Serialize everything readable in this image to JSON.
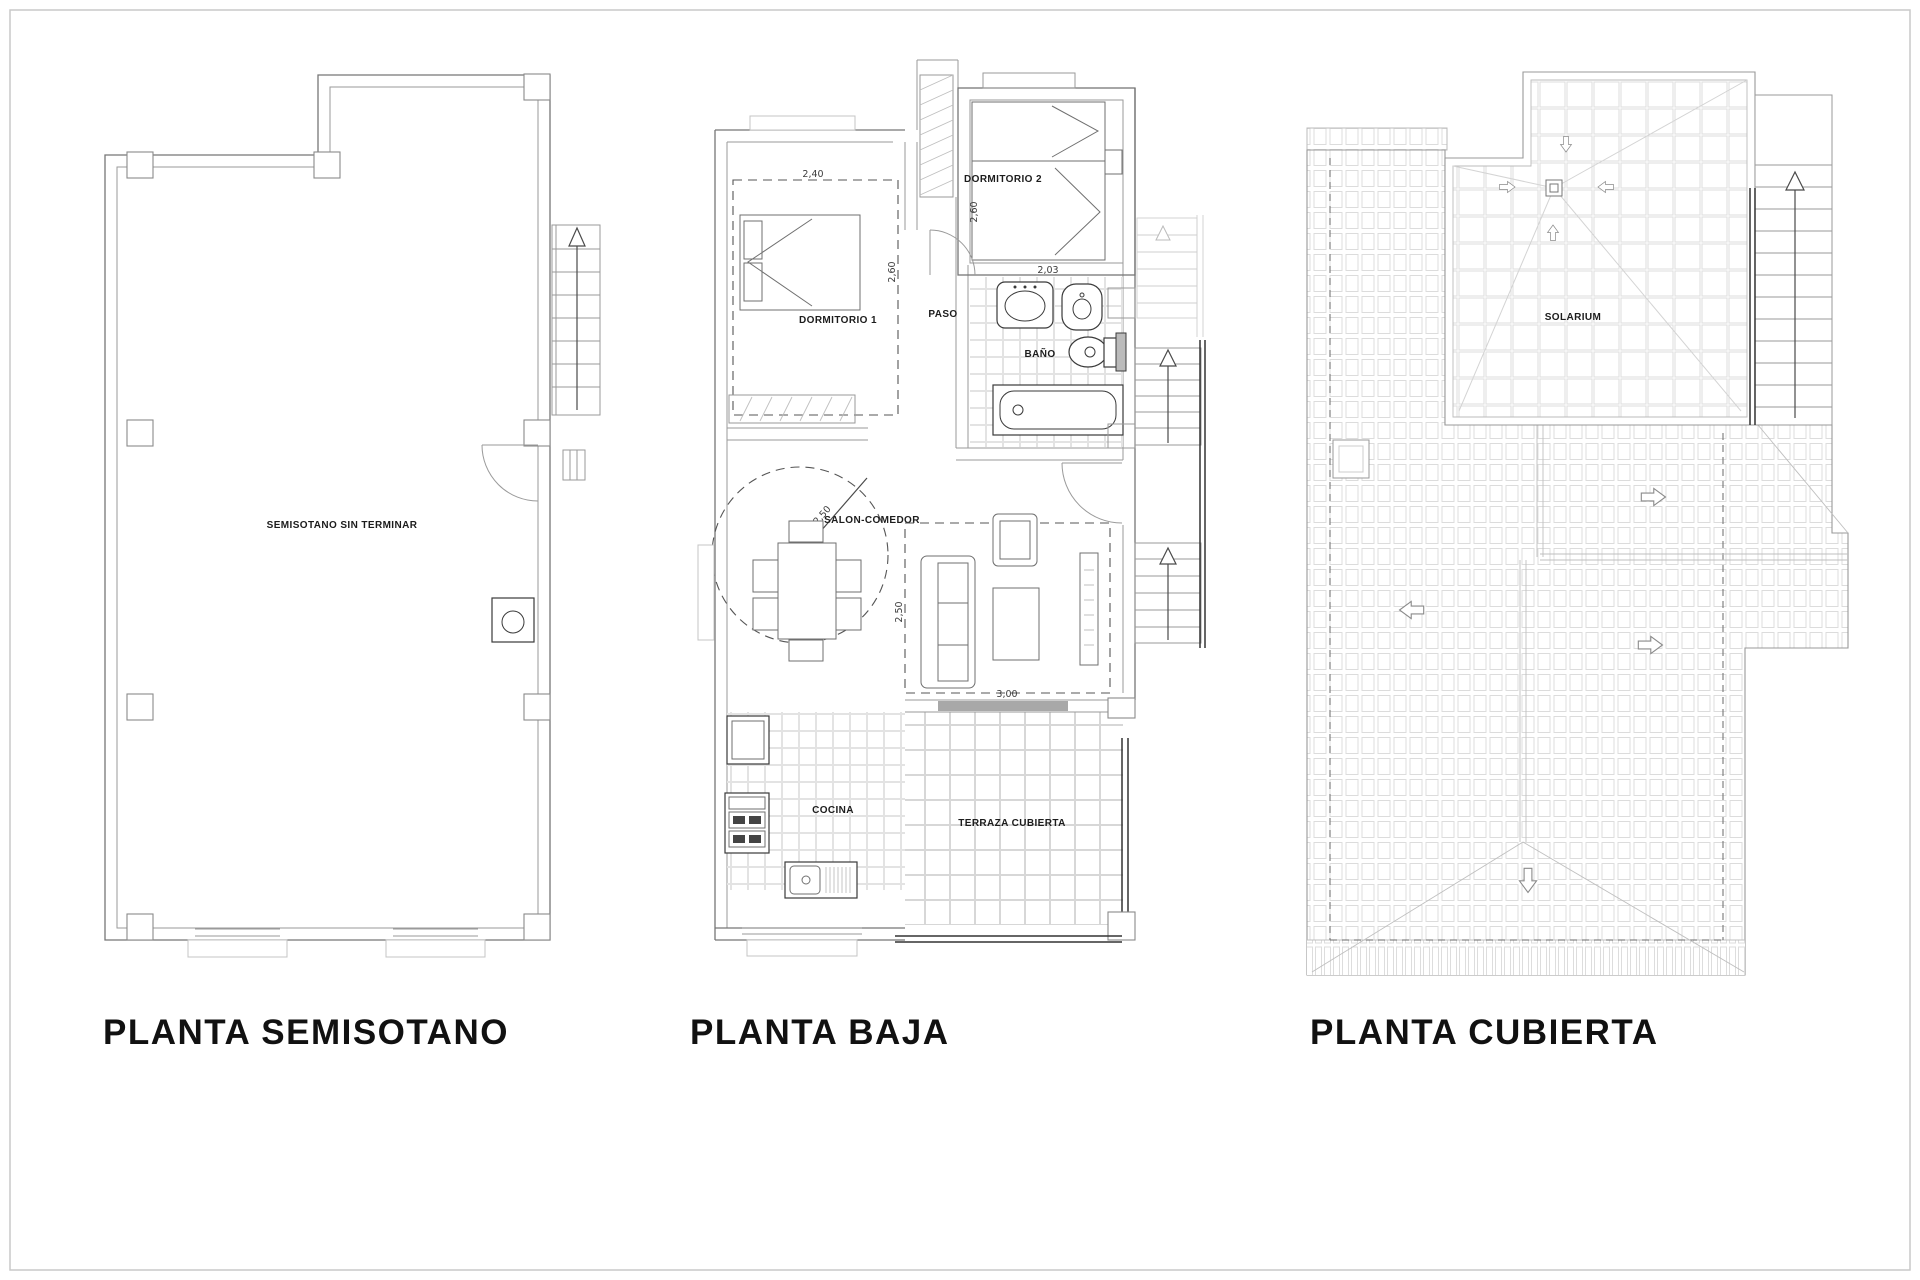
{
  "titles": {
    "semisotano": "PLANTA SEMISOTANO",
    "baja": "PLANTA BAJA",
    "cubierta": "PLANTA CUBIERTA"
  },
  "plan_semisotano": {
    "room": "SEMISOTANO SIN TERMINAR"
  },
  "plan_baja": {
    "rooms": {
      "dormitorio1": "DORMITORIO 1",
      "dormitorio2": "DORMITORIO 2",
      "paso": "PASO",
      "bano": "BAÑO",
      "salon_comedor": "SALON-COMEDOR",
      "cocina": "COCINA",
      "terraza": "TERRAZA CUBIERTA"
    },
    "dimensions": {
      "dormitorio1_width": "2,40",
      "dormitorio1_depth": "2,60",
      "dormitorio2_depth": "2,60",
      "dormitorio2_width": "2,03",
      "salon_circle_diameter": "Ø2,50",
      "salon_depth": "2,50",
      "salon_width": "3,00"
    }
  },
  "plan_cubierta": {
    "room": "SOLARIUM"
  },
  "palette": {
    "background": "#ffffff",
    "sheet_border": "#c9c9c9",
    "wall_line": "#767676",
    "fixture_line": "#3a3a3a",
    "tile_line": "#dcdcdc",
    "dashed_line": "#555555",
    "label_text": "#1c1c1c",
    "title_text": "#111111"
  }
}
